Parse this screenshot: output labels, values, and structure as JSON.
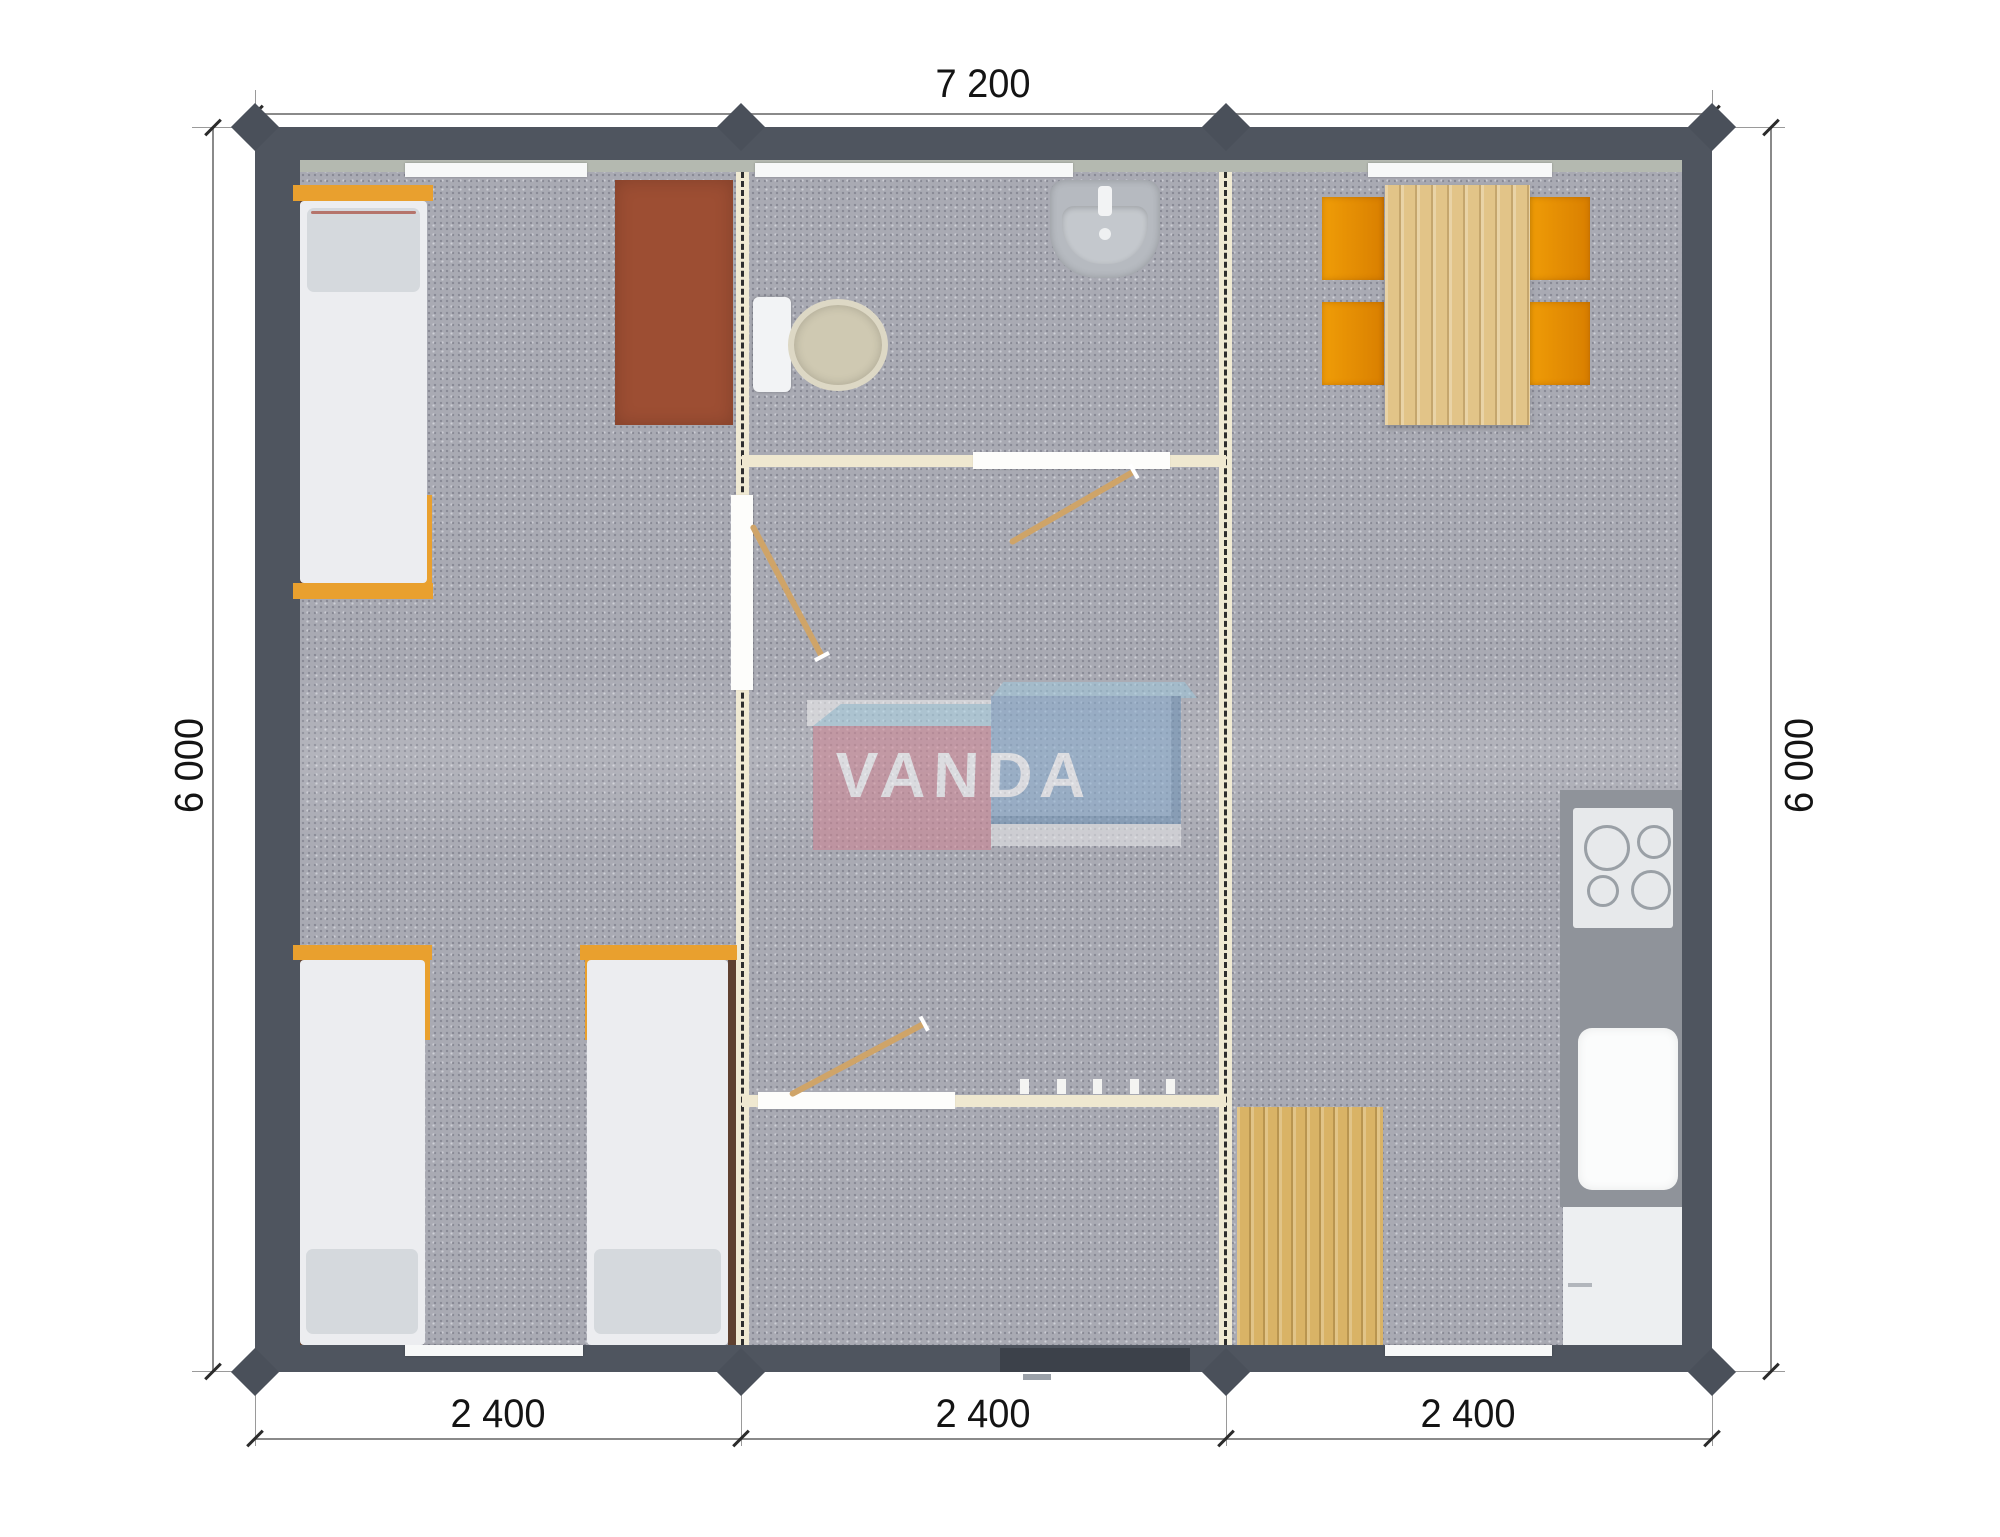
{
  "drawing": {
    "type": "floor-plan",
    "units": "mm"
  },
  "dimensions": {
    "top": "7 200",
    "left": "6 000",
    "right": "6 000",
    "bottom": [
      "2 400",
      "2 400",
      "2 400"
    ]
  },
  "logo": {
    "text": "VANDA",
    "red_box_color": "#cf8392",
    "blue_box_color": "#87abce",
    "sky_top_color": "#abd4e4"
  },
  "colors": {
    "outer_wall": "#4f555f",
    "wall_inner_band": "#b4b9b0",
    "carpet": "#a9aab3",
    "partition_wall": "#f0ead3",
    "bed_frame": "#e9a02e",
    "mattress": "#ecedf0",
    "pillow": "#d5d9dd",
    "wardrobe": "#9d4e33",
    "chair": "#e8900a",
    "wood_table": "#e2c488",
    "wood_mat": "#d9b366",
    "kitchen_counter": "#8f939a",
    "door_swing": "#cfa468"
  }
}
